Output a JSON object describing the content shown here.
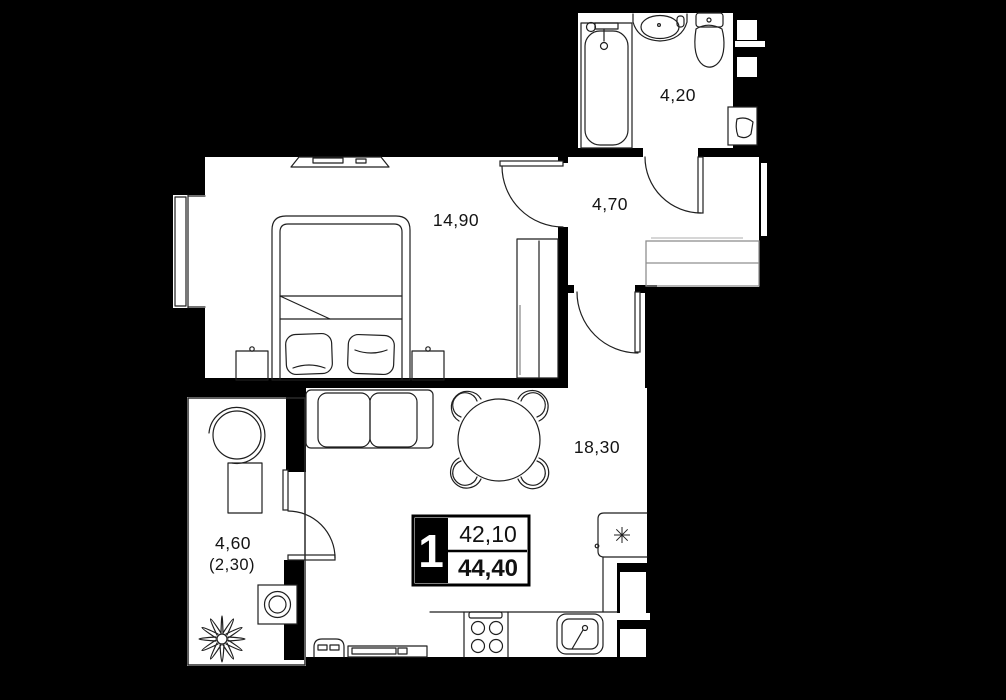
{
  "plan": {
    "unit": {
      "number": "1",
      "area_living": "42,10",
      "area_total": "44,40"
    },
    "rooms": {
      "bathroom": {
        "area": "4,20"
      },
      "hallway": {
        "area": "4,70"
      },
      "bedroom": {
        "area": "14,90"
      },
      "living_kitchen": {
        "area": "18,30"
      },
      "balcony": {
        "area": "4,60",
        "area_coef": "(2,30)"
      }
    },
    "icons": {
      "fridge": "snowflake-icon"
    },
    "colors": {
      "background": "#000000",
      "floor": "#ffffff",
      "wall": "#000000",
      "line": "#1f1f1f",
      "cabinet_line": "#8f8f8f"
    }
  }
}
